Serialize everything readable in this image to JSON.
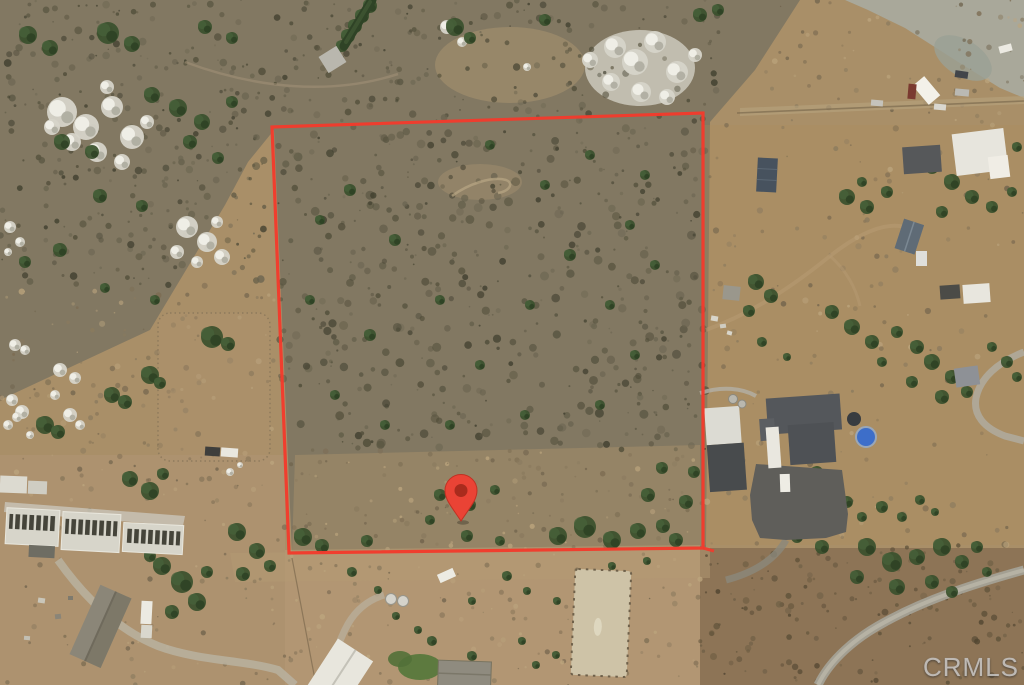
{
  "image": {
    "kind": "aerial-satellite-photo",
    "description": "Aerial view of rural acreage parcel outlined in red with location pin, surrounded by horse ranch structures, rocky hillside and dirt roads",
    "width_px": 1024,
    "height_px": 685
  },
  "watermark": {
    "text": "CRMLS"
  },
  "parcel_boundary": {
    "points": "272,127 703,113 703,548 289,553",
    "color": "#f23a2c"
  },
  "location_marker": {
    "transform": "translate(461,521)",
    "color": "#ea4335",
    "inner_color": "#a92b1d"
  },
  "colors": {
    "watermark_text": "#c9c9c9",
    "terrain_base": "#a98f68",
    "scrub": "#827862",
    "trees": "#39502d",
    "rocks": "#d6d4c9",
    "asphalt": "#5f5e5a"
  }
}
